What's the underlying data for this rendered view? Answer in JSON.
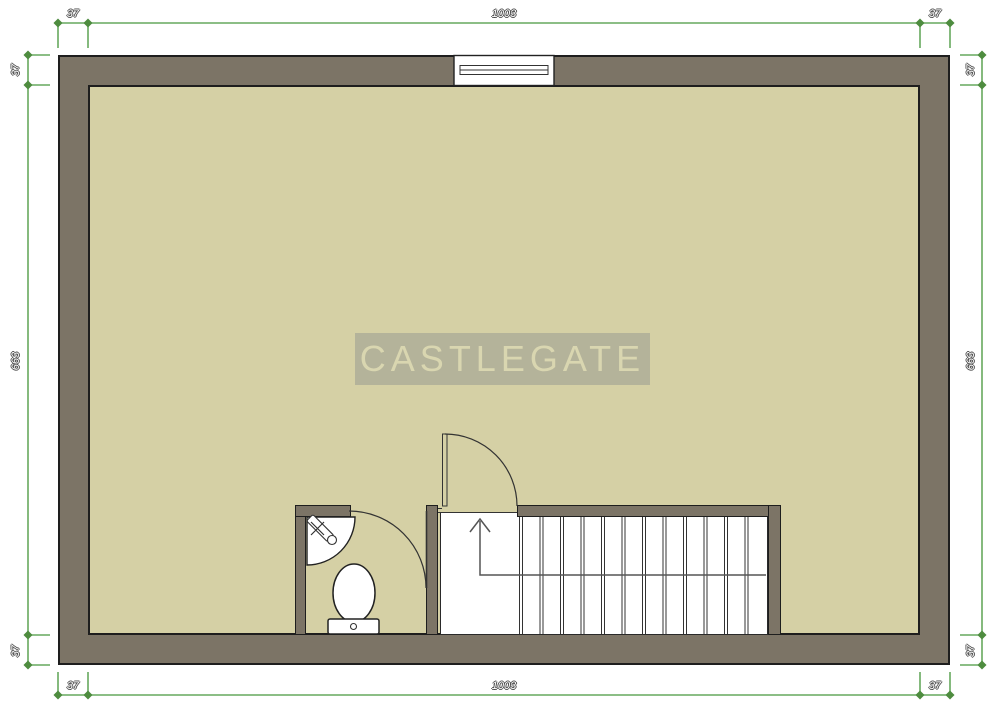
{
  "watermark": {
    "text": "CASTLEGATE"
  },
  "dimensions": {
    "top": {
      "left": "37",
      "center": "1003",
      "right": "37"
    },
    "bottom": {
      "left": "37",
      "center": "1003",
      "right": "37"
    },
    "left": {
      "top": "37",
      "middle": "663",
      "bottom": "37"
    },
    "right": {
      "top": "37",
      "middle": "663",
      "bottom": "37"
    }
  },
  "fixtures": {
    "window": "window",
    "door_main": "hinged-door",
    "door_bathroom": "hinged-door",
    "toilet": "toilet",
    "corner_sink": "corner-sink",
    "stairs": "staircase-up",
    "direction_arrow": "stair-up-arrow"
  },
  "colors": {
    "wall_fill": "#7c7466",
    "floor_fill": "#d5d0a5",
    "outline": "#1e1e1e",
    "dimension_line": "#67a95e",
    "dimension_tick": "#4e8c3f",
    "watermark_bg": "#b4b39a",
    "watermark_text": "#d9d6b0",
    "fixture_fill": "#ffffff"
  }
}
